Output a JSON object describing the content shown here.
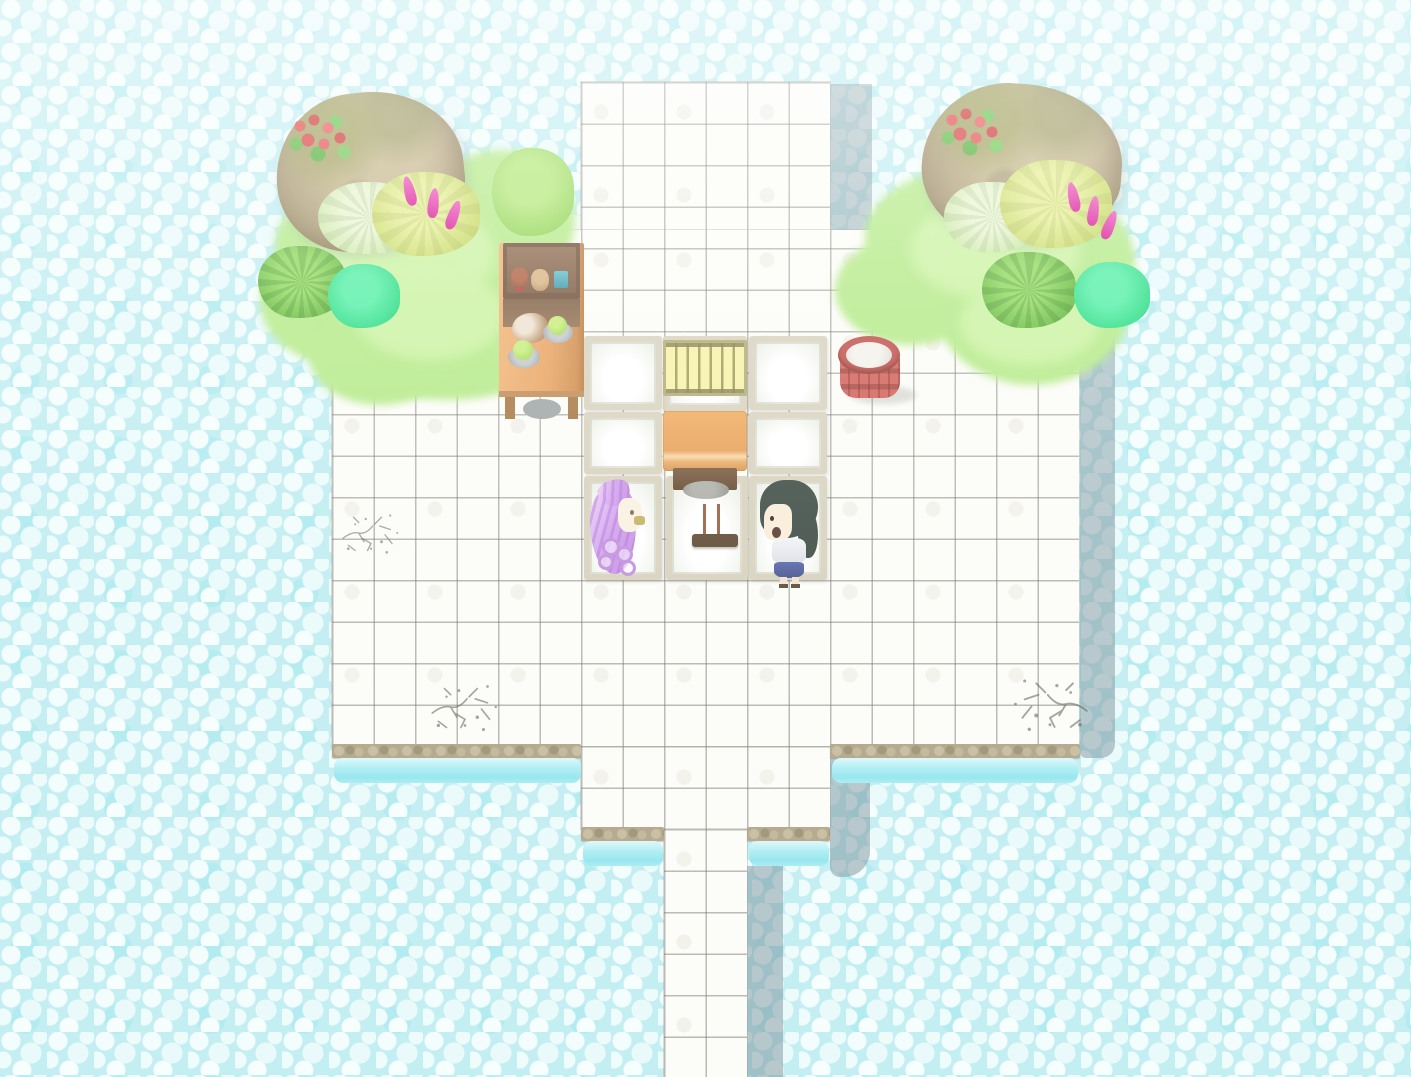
{
  "scene": {
    "kind": "top-down-tile-map",
    "description": "Washed-out pastel game map: white tiled platform over cyan pebble water with a walkway exiting bottom",
    "background": {
      "label": "pebble-water",
      "base_color": "#bfedf1",
      "pebble_color": "#f3fdfd"
    },
    "platform": {
      "label": "white-tile-floor",
      "tile_color": "#fcfcf8",
      "grid_line_color": "#6c6a62",
      "tile_size_px": 41.5,
      "stone_trim_color": "#b0a487",
      "water_edge_color": "#aeeef3",
      "cast_shadow_color": "#768f99"
    },
    "flora": {
      "grass_color": "#b5ea88",
      "rock_color": "#a99871",
      "rock_flower_color": "#d63a3a",
      "bushes": [
        {
          "label": "pale-spiky-bush",
          "color": "#e9f4d0"
        },
        {
          "label": "yellow-green-bush",
          "color": "#d5e470"
        },
        {
          "label": "round-green-bush",
          "color": "#8cd24e"
        },
        {
          "label": "fern-bush",
          "color": "#5cb434"
        },
        {
          "label": "teal-bush",
          "color": "#1fd87c"
        },
        {
          "label": "magenta-flower-spike",
          "color": "#d81694"
        }
      ]
    },
    "furniture": [
      {
        "label": "wooden-shelf-counter",
        "color": "#e8a260",
        "items": [
          "teddy-bear",
          "doll",
          "blue-box",
          "cat",
          "fruit-plate",
          "fruit-plate"
        ]
      },
      {
        "label": "shoji-panel",
        "frame_color": "#d8d2be",
        "fill_color": "#ffffff",
        "count": 8
      },
      {
        "label": "bamboo-mat",
        "color": "#f6f2a8"
      },
      {
        "label": "wooden-table",
        "color": "#e8a158"
      },
      {
        "label": "floor-cushion",
        "color": "#a0a09a"
      },
      {
        "label": "incense-tray",
        "color": "#5f4a35",
        "stick_count": 2
      },
      {
        "label": "red-water-barrel",
        "wood_color": "#c2514b",
        "water_color": "#f4f2ea"
      }
    ],
    "characters": [
      {
        "label": "npc-lavender-hair",
        "hair_color": "#d2a6ec",
        "facing": "right"
      },
      {
        "label": "npc-dark-green-hair",
        "hair_color": "#3e4d45",
        "top_color": "#f2f4f6",
        "skirt_color": "#5a69ab",
        "facing": "left"
      }
    ],
    "decals": [
      {
        "label": "floor-crack",
        "count": 3,
        "color": "#5f5f57"
      }
    ]
  }
}
